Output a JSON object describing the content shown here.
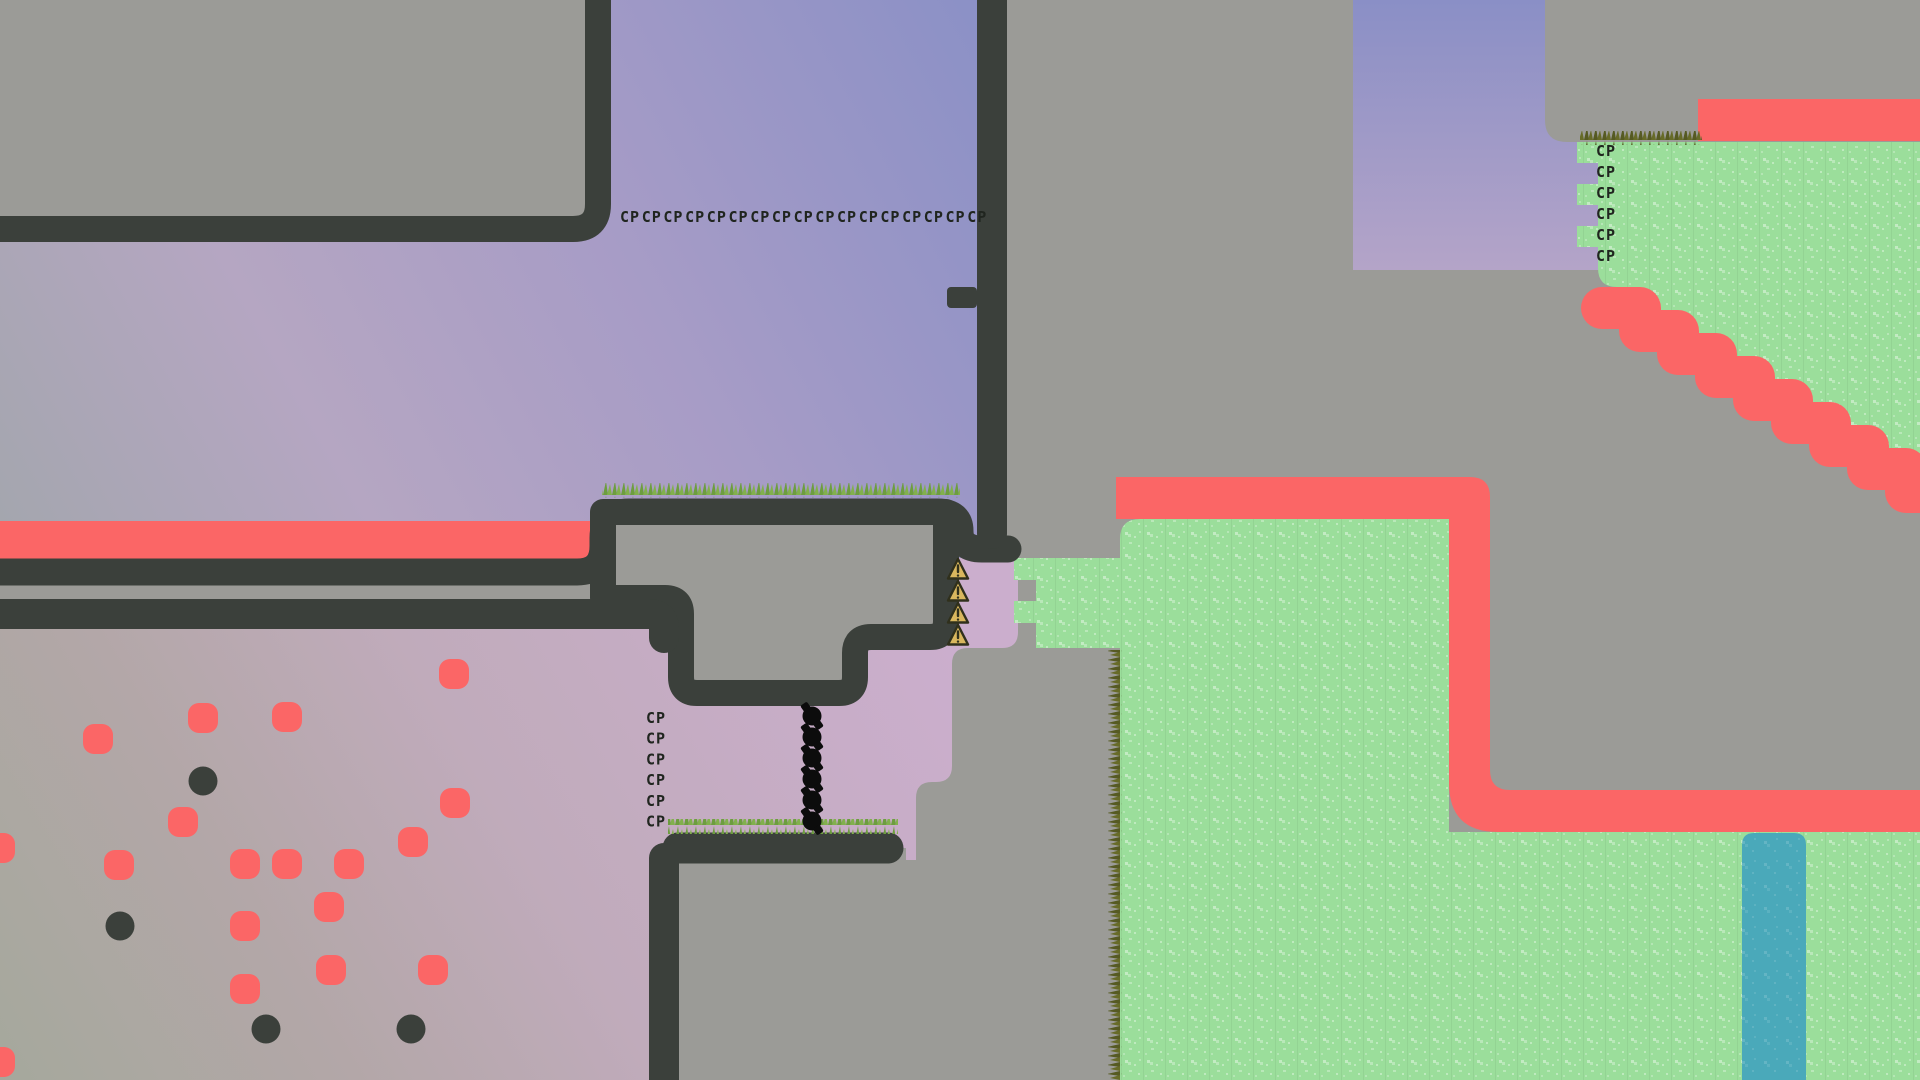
{
  "scene": {
    "title": "2D platformer map view",
    "description": "Side-scrolling game world with checkpoint markers, kill stripes, grass terrain and water"
  },
  "colors": {
    "base_gray": "#9b9b97",
    "border_dark": "#3b403b",
    "kill_red": "#fb6666",
    "grass_green": "#9bde9b",
    "water_teal": "#4aa9ba",
    "warning_gold": "#d9b75e",
    "text_dark": "#20251f",
    "dot_dark": "#3b403b"
  },
  "checkpoints": {
    "label": "CP",
    "top_row": {
      "count": 17,
      "x0": 620,
      "dx": 21.7,
      "y": 222
    },
    "left_column": {
      "count": 6,
      "x": 646,
      "y0": 723,
      "dy": 20.7
    },
    "right_column": {
      "count": 6,
      "x": 1596,
      "y0": 156,
      "dy": 21
    }
  },
  "markers": {
    "warning_triangles": {
      "icon": "warning-triangle-icon",
      "x": 958,
      "ys": [
        570,
        592,
        614,
        636
      ]
    },
    "spike_blobs": {
      "icon": "spike-blob-icon",
      "x": 812,
      "ys": [
        716,
        737,
        758,
        779,
        800,
        821
      ]
    }
  },
  "dots": {
    "red": [
      [
        454,
        674
      ],
      [
        203,
        718
      ],
      [
        287,
        717
      ],
      [
        98,
        739
      ],
      [
        455,
        803
      ],
      [
        183,
        822
      ],
      [
        413,
        842
      ],
      [
        119,
        865
      ],
      [
        245,
        864
      ],
      [
        287,
        864
      ],
      [
        349,
        864
      ],
      [
        329,
        907
      ],
      [
        245,
        926
      ],
      [
        331,
        970
      ],
      [
        433,
        970
      ],
      [
        245,
        989
      ],
      [
        0,
        848
      ],
      [
        0,
        1062
      ]
    ],
    "dark": [
      [
        203,
        781
      ],
      [
        120,
        926
      ],
      [
        266,
        1029
      ],
      [
        411,
        1029
      ]
    ]
  },
  "regions": [
    {
      "name": "solid-wall",
      "color": "#9b9b97"
    },
    {
      "name": "wall-border",
      "color": "#3b403b"
    },
    {
      "name": "kill-stripe",
      "color": "#fb6666"
    },
    {
      "name": "grass-zone",
      "color": "#9bde9b"
    },
    {
      "name": "water-strip",
      "color": "#4aa9ba"
    },
    {
      "name": "sky-gradient-pocket",
      "color": "#8a90c6"
    }
  ]
}
